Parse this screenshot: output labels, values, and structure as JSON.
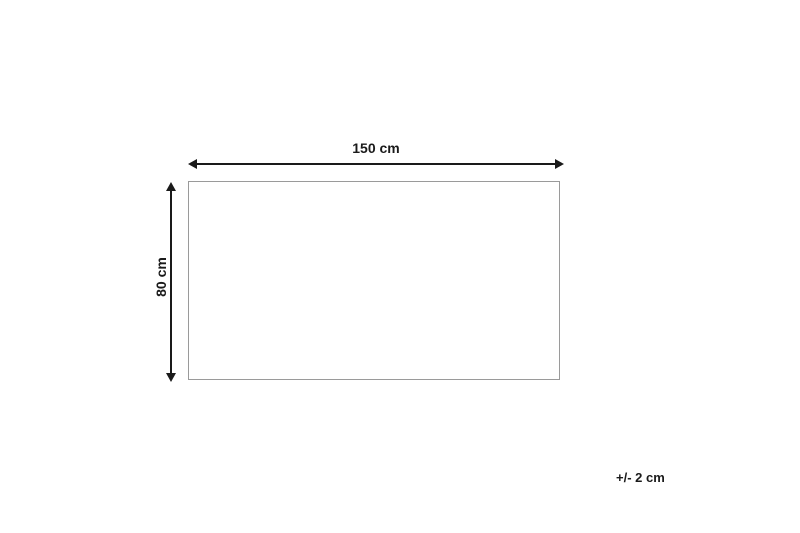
{
  "diagram": {
    "width_dimension": {
      "label": "150 cm"
    },
    "height_dimension": {
      "label": "80 cm"
    },
    "tolerance": {
      "label": "+/- 2 cm"
    },
    "colors": {
      "arrow": "#1a1a1a",
      "outline": "#9a9a9a",
      "background": "#ffffff"
    }
  }
}
